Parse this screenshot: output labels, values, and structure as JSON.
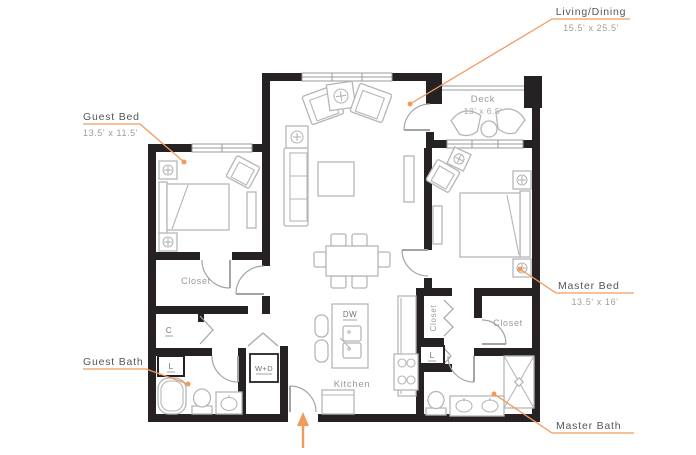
{
  "colors": {
    "accent": "#F19A5C",
    "wall": "#262223",
    "furniture": "#B4B6B8",
    "label_text": "#55565A",
    "dim_text": "#9C9EA0"
  },
  "callouts": {
    "living_dining": {
      "label": "Living/Dining",
      "dims": "15.5' x 25.5'"
    },
    "guest_bed": {
      "label": "Guest Bed",
      "dims": "13.5' x 11.5'"
    },
    "master_bed": {
      "label": "Master Bed",
      "dims": "13.5' x 16'"
    },
    "guest_bath": {
      "label": "Guest Bath"
    },
    "master_bath": {
      "label": "Master Bath"
    }
  },
  "rooms": {
    "deck": {
      "label": "Deck",
      "dims": "13' x 6.5'"
    },
    "kitchen": {
      "label": "Kitchen"
    },
    "guest_closet": {
      "label": "Closet"
    },
    "master_closet": {
      "label": "Closet"
    },
    "hall_closet": {
      "label": "Closet"
    },
    "coat_closet": {
      "label": "C"
    },
    "linen_guest": {
      "label": "L"
    },
    "linen_hall": {
      "label": "L"
    },
    "washer_dryer": {
      "label": "W+D"
    },
    "dishwasher": {
      "label": "DW"
    }
  }
}
